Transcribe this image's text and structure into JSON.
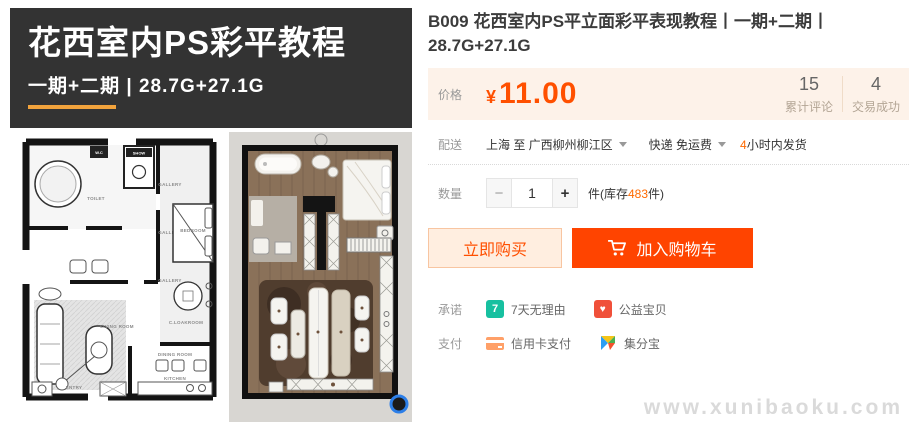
{
  "banner": {
    "title": "花西室内PS彩平教程",
    "subtitle": "一期+二期 | 28.7G+27.1G"
  },
  "product": {
    "title": "B009 花西室内PS平立面彩平表现教程丨一期+二期丨28.7G+27.1G"
  },
  "price": {
    "label": "价格",
    "currency": "¥",
    "amount": "11.00"
  },
  "stats": {
    "reviews_count": "15",
    "reviews_label": "累计评论",
    "deals_count": "4",
    "deals_label": "交易成功"
  },
  "delivery": {
    "label": "配送",
    "route": "上海 至  广西柳州柳江区",
    "shipping": "快递 免运费",
    "ship_highlight": "4",
    "ship_text": "小时内发货"
  },
  "quantity": {
    "label": "数量",
    "minus": "−",
    "plus": "+",
    "value": "1",
    "unit_prefix": "件(库存",
    "stock": "483",
    "unit_suffix": "件)"
  },
  "actions": {
    "buy_now": "立即购买",
    "add_to_cart": "加入购物车"
  },
  "promise": {
    "label": "承诺",
    "items": [
      {
        "icon": "7-day-return-icon",
        "badge": "7",
        "text": "7天无理由"
      },
      {
        "icon": "charity-heart-icon",
        "badge": "♥",
        "text": "公益宝贝"
      }
    ]
  },
  "payment": {
    "label": "支付",
    "items": [
      {
        "icon": "credit-card-icon",
        "text": "信用卡支付"
      },
      {
        "icon": "jifenbao-pinwheel-icon",
        "text": "集分宝"
      }
    ]
  },
  "watermark": "www.xunibaoku.com",
  "colors": {
    "accent": "#ff5000",
    "cart_button": "#ff4400",
    "banner_bg": "#333333",
    "banner_underline": "#f2a33c",
    "price_box_bg": "#fdf2e9",
    "stock_highlight": "#ff6a00"
  },
  "plans": {
    "left_labels": {
      "wc": "W.C",
      "show": "SHOW",
      "toilet": "TOILET",
      "gallery": "GALLERY",
      "bedroom": "BEDROOM",
      "living": "LIVING ROOM",
      "cloak": "C.LOAKROOM",
      "dining": "DINING ROOM",
      "kitchen": "KITCHEN",
      "entry": "ENTRY"
    }
  }
}
